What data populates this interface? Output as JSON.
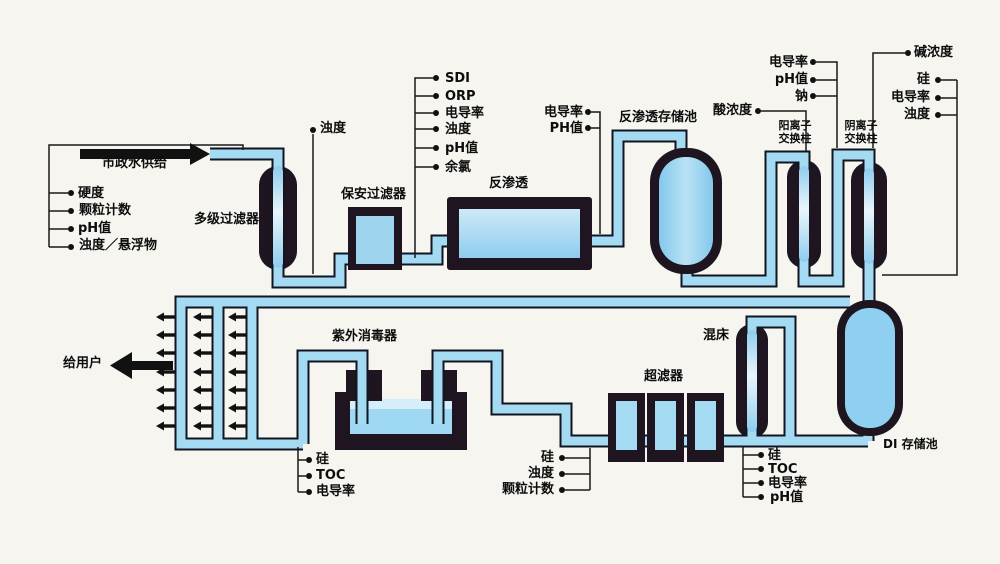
{
  "colors": {
    "background": "#f6f5f0",
    "pipe_fill": "#a4daf2",
    "pipe_outline": "#101522",
    "vessel_dark": "#1e1520",
    "vessel_blue": "#8ccbee",
    "line_black": "#1a1a1a"
  },
  "labels": {
    "municipal_supply": "市政水供给",
    "to_users": "给用户",
    "equipment": {
      "multistage_filter": "多级过滤器",
      "security_filter": "保安过滤器",
      "reverse_osmosis": "反渗透",
      "ro_storage_tank": "反渗透存储池",
      "cation_exchange": "阳离子\n交换柱",
      "anion_exchange": "阴离子\n交换柱",
      "uv_sterilizer": "紫外消毒器",
      "ultrafilter": "超滤器",
      "mixed_bed": "混床",
      "di_storage_tank": "DI 存储池"
    },
    "dosing": {
      "acid": "酸浓度",
      "alkali": "碱浓度"
    },
    "sensors": {
      "feed": [
        "硬度",
        "颗粒计数",
        "pH值",
        "浊度／悬浮物"
      ],
      "after_multistage": [
        "浊度"
      ],
      "before_ro": [
        "SDI",
        "ORP",
        "电导率",
        "浊度",
        "pH值",
        "余氯"
      ],
      "ro_product": [
        "电导率",
        "PH值"
      ],
      "cation_product": [
        "电导率",
        "pH值",
        "钠"
      ],
      "anion_product": [
        "硅",
        "电导率",
        "浊度"
      ],
      "uv_product": [
        "硅",
        "TOC",
        "电导率"
      ],
      "uf_feed": [
        "硅",
        "浊度",
        "颗粒计数"
      ],
      "di_product": [
        "硅",
        "TOC",
        "电导率",
        "pH值"
      ]
    }
  }
}
